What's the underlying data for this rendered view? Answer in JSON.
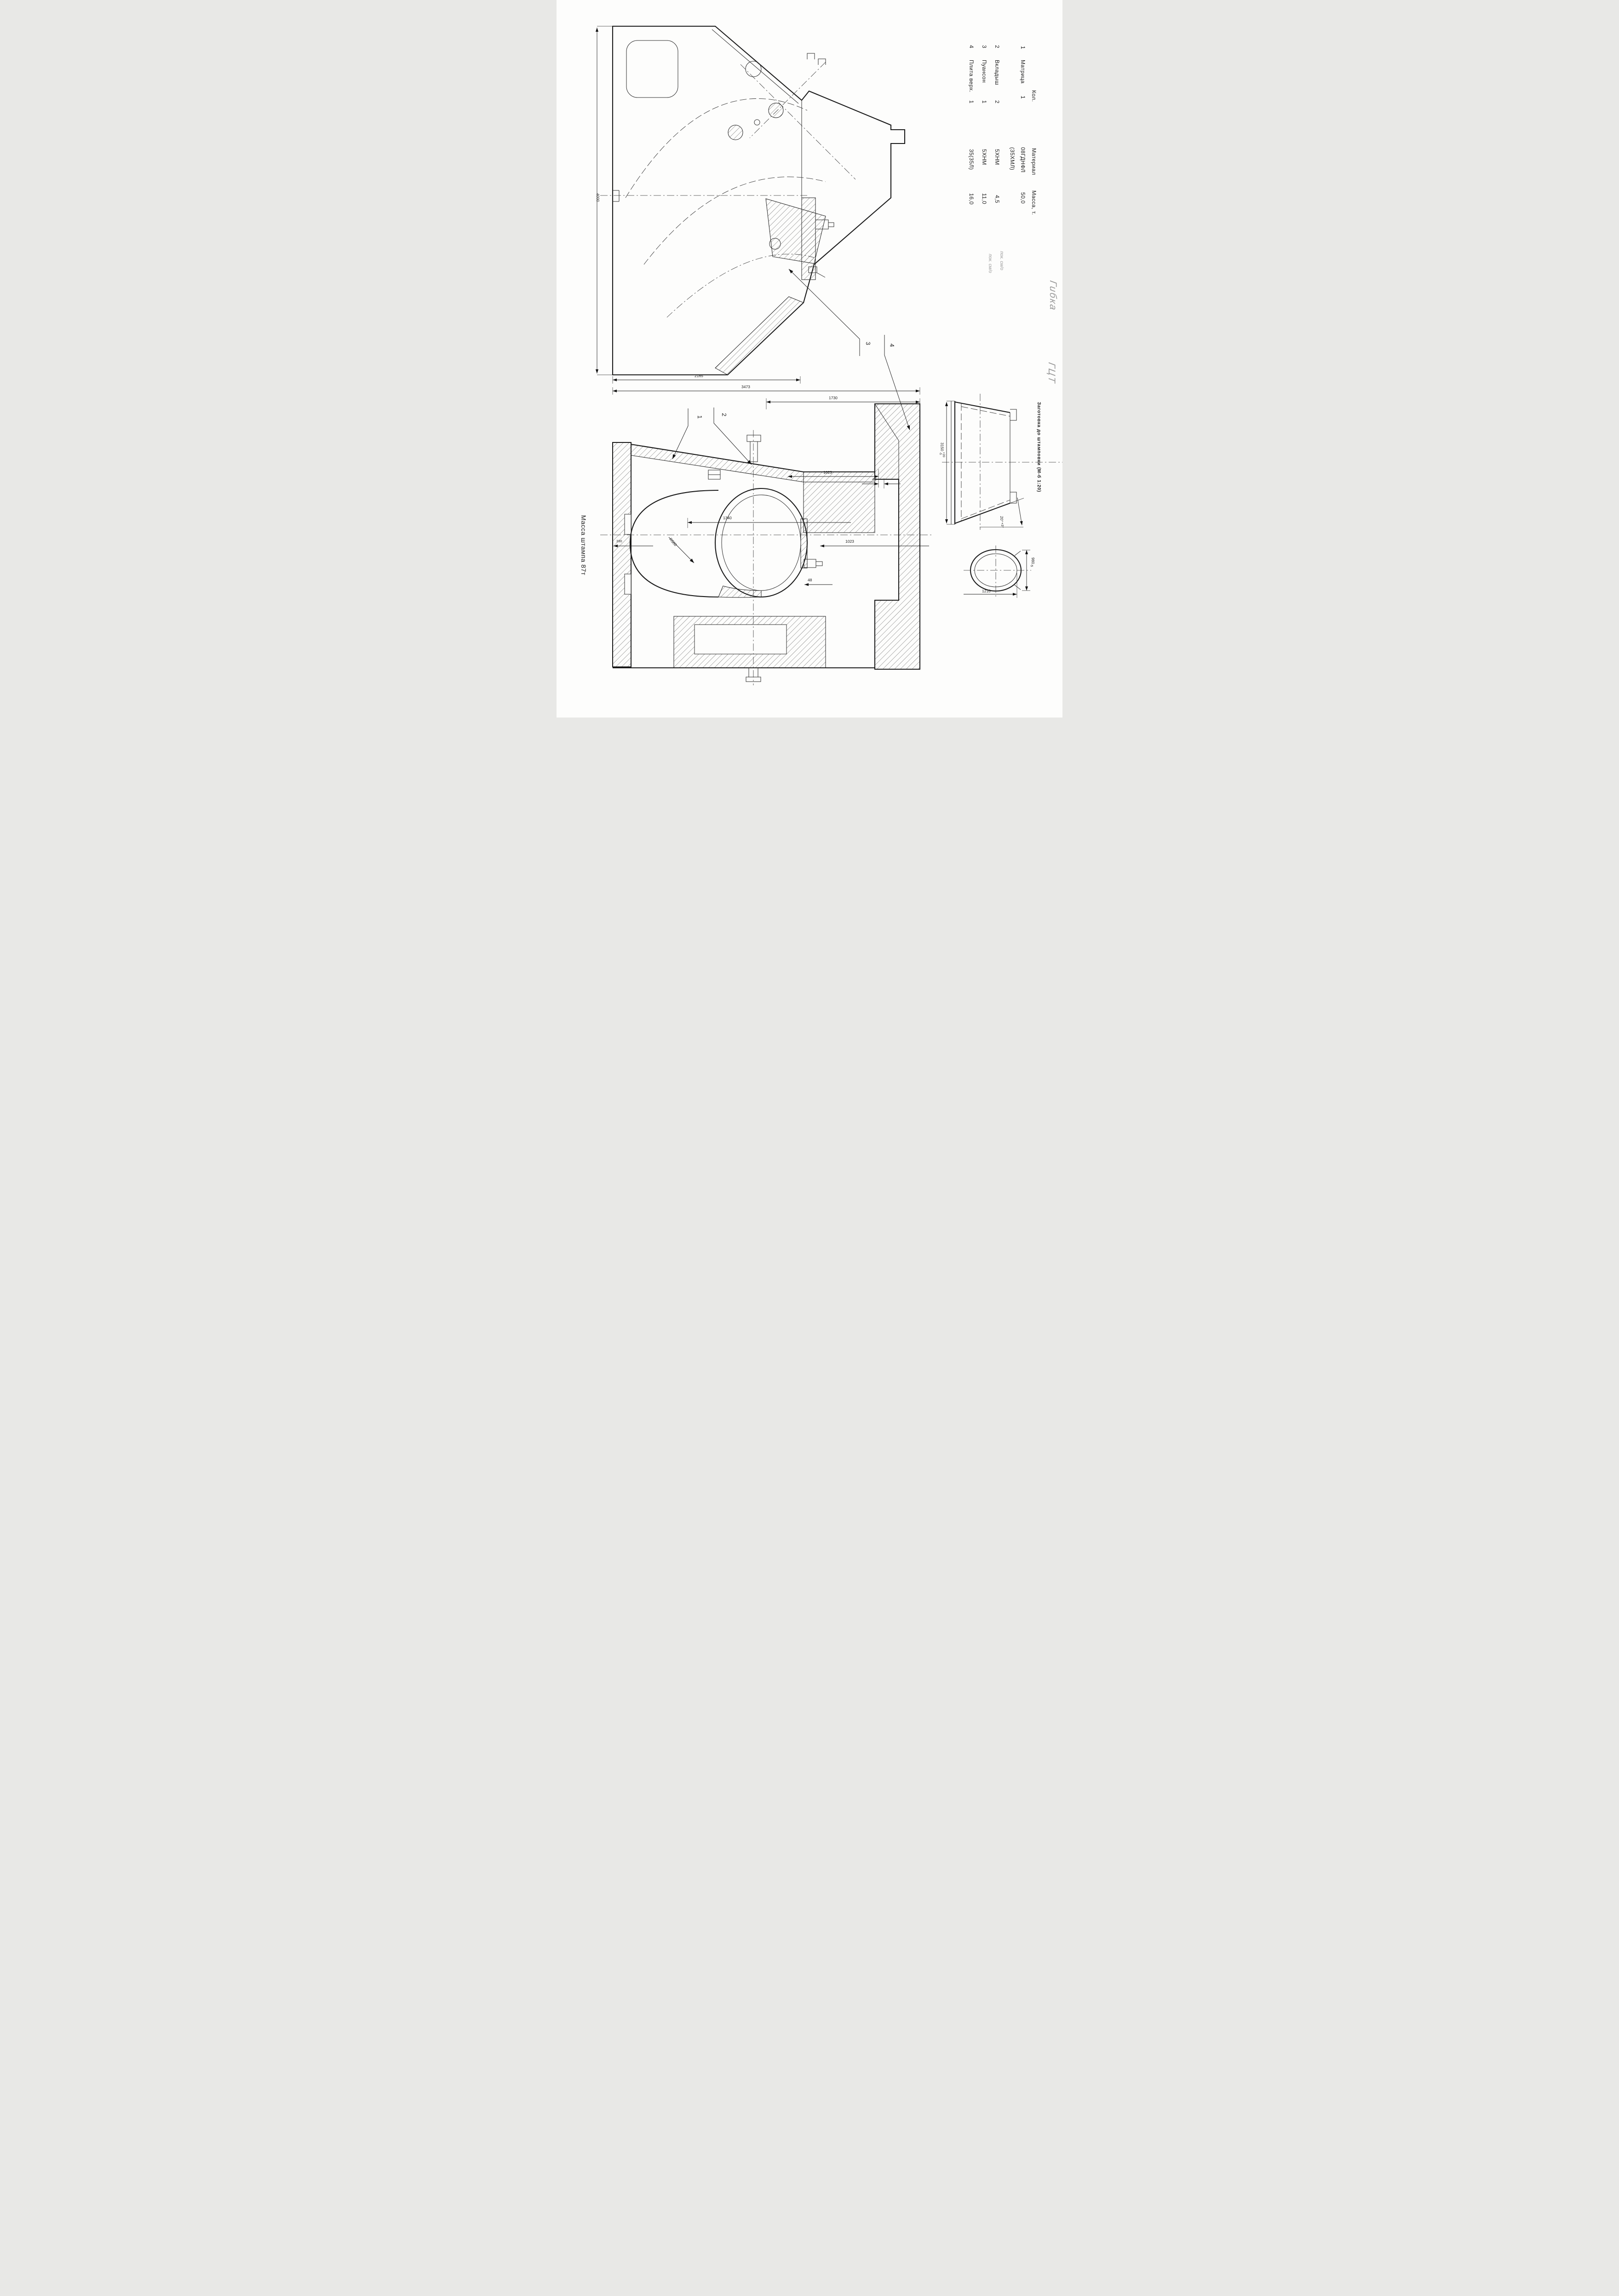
{
  "drawing": {
    "mass_note": "Масса штампа 87т",
    "handwritten_title_line1": "Гибка",
    "handwritten_title_line2": "ГЦТ",
    "pencil_note_row2": "пок. см/о",
    "pencil_note_row3": "пок. см/о"
  },
  "table": {
    "headers": {
      "qty": "Кол.",
      "material": "Материал",
      "mass": "Масса, т."
    },
    "rows": [
      {
        "no": "1",
        "name": "Матрица",
        "alt_material": "(35ХМЛ)",
        "qty": "1",
        "material": "08ГДНФЛ",
        "mass": "50,0"
      },
      {
        "no": "2",
        "name": "Вкладыш",
        "qty": "2",
        "material": "5ХНМ",
        "mass": "4,5"
      },
      {
        "no": "3",
        "name": "Пуансон",
        "qty": "1",
        "material": "5ХНМ",
        "mass": "11,0"
      },
      {
        "no": "4",
        "name": "Плита верх.",
        "qty": "1",
        "material": "35(35Л)",
        "mass": "16,0"
      }
    ]
  },
  "callouts": {
    "c1": "1",
    "c2": "2",
    "c3": "3",
    "c4": "4"
  },
  "dimensions": {
    "upper_height": "4000",
    "upper_width": "2165",
    "overall_width": "3473",
    "flange_span": "1730",
    "punch_width": "1023",
    "punch_lip": "40",
    "cavity_width": "1340",
    "flange_width": "1023",
    "step": "48",
    "wall_step": "330",
    "cavity_radius": "R500"
  },
  "blank": {
    "caption": "Заготовка до штамповки (М-б 1:20)",
    "height": "3150",
    "height_tol_plus": "+20",
    "height_tol_minus": "-5",
    "angle": "20°",
    "angle_tol": "+3°",
    "section_height": "980",
    "section_height_tol": "-5",
    "section_width": "1210"
  }
}
